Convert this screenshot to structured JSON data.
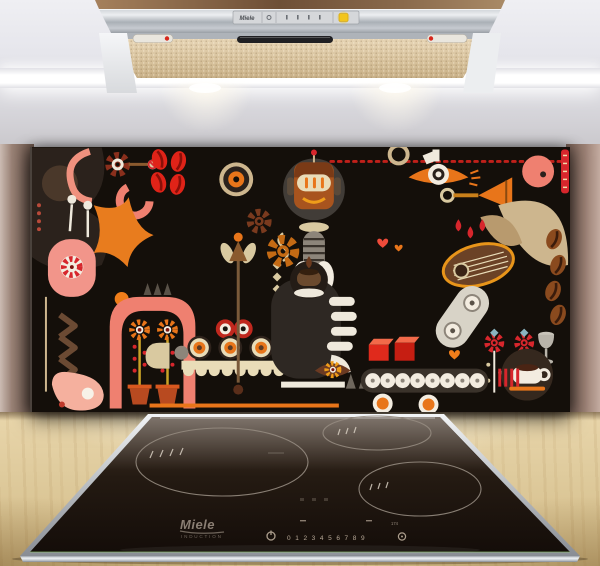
{
  "scene": {
    "alt": "Kitchen with extractor hood, abstract coffee-art glass splashback and induction hob on a wooden worktop"
  },
  "hood": {
    "brand": "Miele",
    "light_indicator_color": "#f2c51d"
  },
  "splashback": {
    "art_background": "#140f0a",
    "palette": [
      "#d7262c",
      "#e02318",
      "#e8751a",
      "#ef9d1a",
      "#ef8070",
      "#f2958a",
      "#e9dcb8",
      "#cdb68e",
      "#8a4a1e",
      "#6b4226",
      "#2e2823",
      "#f3ece0"
    ]
  },
  "cooktop": {
    "brand": "Miele",
    "series_label": "INDUCTION",
    "digit_scale": "0 1 2 3 4 5 6 7 8 9",
    "timer_display": "174"
  },
  "colors": {
    "wall_upper": "#e4e4ea",
    "wall_left": "#8d7368",
    "wall_right": "#9b8074",
    "worktop_wood": "#ddc89c",
    "stainless": "#c9ccd1",
    "hob_glass": "#1a120d"
  }
}
